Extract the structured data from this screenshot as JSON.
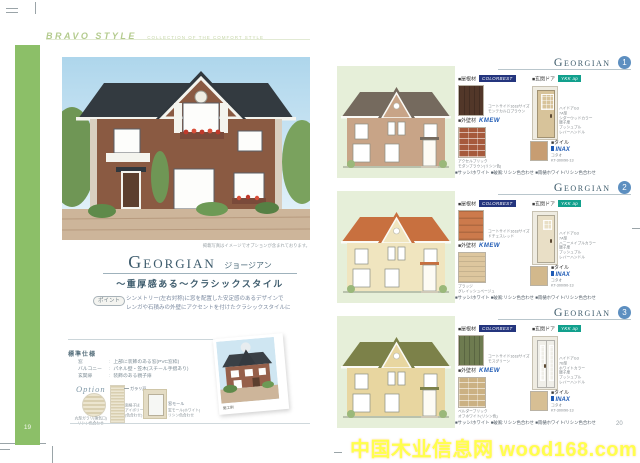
{
  "watermark": {
    "text": "中国木业信息网 wood168.com",
    "color": "#ffff4d"
  },
  "header": {
    "brand": "BRAVO STYLE",
    "tagline": "COLLECTION OF THE COMFORT STYLE"
  },
  "left_page": {
    "page_number": "19",
    "photo_caption": "掲載写真はイメージでオプションが含まれております。",
    "title": "Georgian",
    "title_kana": "ジョージアン",
    "subtitle": "〜重厚感ある〜クラシックスタイル",
    "point_label": "ポイント",
    "point_text": "シンメトリー(左右対称)に窓を配置した安定感のあるデザインで\nレンガや石積みの外壁にアクセントを付けたクラシックスタイルに",
    "spec_title": "標準仕様",
    "spec_rows": [
      {
        "label": "窓",
        "value": "上部に装飾のある窓(PVC窓枠)"
      },
      {
        "label": "バルコニー",
        "value": "パネル壁・笠木(スチール手摺あり)"
      },
      {
        "label": "玄関扉",
        "value": "装飾のある親子扉"
      }
    ],
    "option_title": "Option",
    "options": [
      {
        "label": "丸型ガラリ",
        "caption": "丸型ガラリ(換気口)\nリシン色合わせ"
      },
      {
        "label": "ガラリ戸",
        "caption": "面格子は\nアイボリー\n(色合わせ)"
      },
      {
        "label": "窓モール",
        "caption": "窓モール(ホワイト)\nリシン色合わせ"
      }
    ],
    "example_caption": "施工例"
  },
  "right_page": {
    "page_number": "20",
    "sections": [
      {
        "title": "Georgian",
        "number": "1",
        "roof_label": "■屋根材",
        "roof_brand": "COLORBEST",
        "roof_caption": "コートサイド1618サイズ\nモンテカルロブラウン",
        "wall_label": "■外壁材",
        "wall_brand": "KMEW",
        "wall_caption": "アクセルブリック\nモダンブラウン(リシン色)",
        "door_label": "■玄関ドア",
        "door_brand": "YKK ap",
        "door_caption": "ハイドアG3\n7A型\nシダーウッドカラー\n親子扉\nプッシュプル\nレバーハンドル",
        "tile_label": "■タイル",
        "tile_brand": "INAX",
        "tile_caption": "コタオ\nKT-300/90-13",
        "footnote": "■サッシ/ホワイト ■破風:リシン色合わせ ■雨樋ホワイト/リシン色合わせ",
        "colors": {
          "panel": "#e6efd9",
          "house_roof": "#756a5e",
          "house_wall": "#c8a487",
          "swatch_roof": "#523729",
          "swatch_wall": "#a65a3c",
          "door": "#d7c39a",
          "tile": "#c79d72"
        }
      },
      {
        "title": "Georgian",
        "number": "2",
        "roof_label": "■屋根材",
        "roof_brand": "COLORBEST",
        "roof_caption": "コートサイド1618サイズ\nドチェスレッド",
        "wall_label": "■外壁材",
        "wall_brand": "KMEW",
        "wall_caption": "プラッジ\nグレイッシュベージュ",
        "door_label": "■玄関ドア",
        "door_brand": "YKK ap",
        "door_caption": "ハイドアG3\n7A型\nハニーメイプルカラー\n親子扉\nプッシュプル\nレバーハンドル",
        "tile_label": "■タイル",
        "tile_brand": "INAX",
        "tile_caption": "コタオ\nKT-300/90-13",
        "footnote": "■サッシ/ホワイト ■破風:リシン色合わせ ■雨樋ホワイト/リシン色合わせ",
        "colors": {
          "panel": "#e6efd9",
          "house_roof": "#c8703f",
          "house_wall": "#f0e5bf",
          "swatch_roof": "#cc7a4c",
          "swatch_wall": "#ddc69e",
          "door": "#e9dfc6",
          "tile": "#d2b88c"
        }
      },
      {
        "title": "Georgian",
        "number": "3",
        "roof_label": "■屋根材",
        "roof_brand": "COLORBEST",
        "roof_caption": "コートサイド1618サイズ\nモスグリーン",
        "wall_label": "■外壁材",
        "wall_brand": "KMEW",
        "wall_caption": "ベルダーブリック\nオフホワイト(リシン色)",
        "door_label": "■玄関ドア",
        "door_brand": "YKK ap",
        "door_caption": "ハイドアG3\n7B型\nホワイトカラー\n親子扉\nプッシュプル\nレバーハンドル",
        "tile_label": "■タイル",
        "tile_brand": "INAX",
        "tile_caption": "コタオ\nKT-300/90-13",
        "footnote": "■サッシ/ホワイト ■破風:リシン色合わせ ■雨樋ホワイト/リシン色合わせ",
        "colors": {
          "panel": "#e6efd9",
          "house_roof": "#7c8149",
          "house_wall": "#e8d6a0",
          "swatch_roof": "#6e7b50",
          "swatch_wall": "#cbb183",
          "door": "#f0efe9",
          "tile": "#d7bf94"
        }
      }
    ]
  }
}
